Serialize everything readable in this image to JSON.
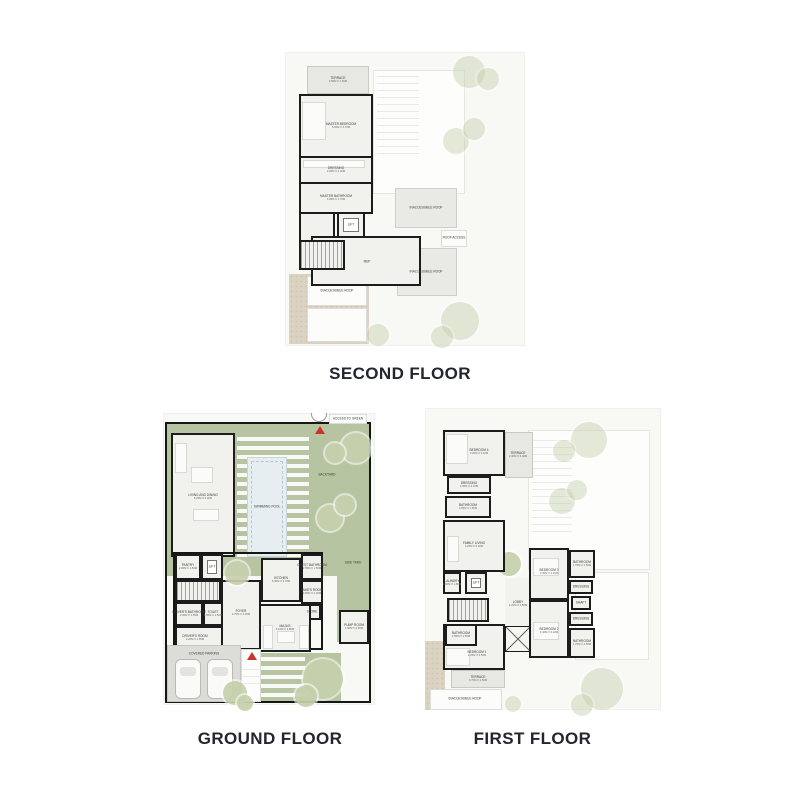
{
  "colors": {
    "wall": "#1c1c1c",
    "yard_green": "#b6c4a2",
    "pool_blue": "#e7eef1",
    "sand_beige": "#dbd3c2",
    "entry_red": "#c9342a",
    "title_text": "#23262e"
  },
  "titles": {
    "second": "SECOND FLOOR",
    "ground": "GROUND FLOOR",
    "first": "FIRST FLOOR"
  },
  "second": {
    "terrace": {
      "name": "TERRACE",
      "dims": "3.50M X 1.50M"
    },
    "master_bedroom": {
      "name": "MASTER BEDROOM",
      "dims": "5.95M X 4.70M"
    },
    "dressing": {
      "name": "DRESSING",
      "dims": "2.95M X 2.20M"
    },
    "master_bathroom": {
      "name": "MASTER BATHROOM",
      "dims": "3.95M X 2.70M"
    },
    "lift": {
      "name": "LIFT"
    },
    "mep": {
      "name": "MEP"
    },
    "roof_right_top": {
      "name": "INACCESSIBLE ROOF"
    },
    "roof_access": {
      "name": "ROOF ACCESS"
    },
    "roof_right_bottom": {
      "name": "INACCESSIBLE ROOF"
    },
    "roof_bottom_left": {
      "name": "INACCESSIBLE ROOF"
    }
  },
  "ground": {
    "access_to_green": {
      "name": "ACCESS TO GREEN"
    },
    "backyard": {
      "name": "BACKYARD"
    },
    "swimming_pool": {
      "name": "SWIMMING POOL"
    },
    "living_dining": {
      "name": "LIVING AND DINING",
      "dims": "8.25M X 6.00M"
    },
    "pantry": {
      "name": "PANTRY",
      "dims": "2.00M X 1.50M"
    },
    "lift": {
      "name": "LIFT"
    },
    "drivers_bathroom": {
      "name": "DRIVER'S BATHROOM",
      "dims": "2.00M X 1.55M"
    },
    "toilet": {
      "name": "TOILET",
      "dims": "2.00M X 1.50M"
    },
    "drivers_room": {
      "name": "DRIVER'S ROOM",
      "dims": "3.20M X 1.55M"
    },
    "covered_parking": {
      "name": "COVERED PARKING"
    },
    "foyer": {
      "name": "FOYER",
      "dims": "2.70M X 4.00M"
    },
    "kitchen": {
      "name": "KITCHEN",
      "dims": "5.40M X 3.70M"
    },
    "guest_bathroom": {
      "name": "GUEST BATHROOM",
      "dims": "2.55M X 1.50M"
    },
    "maids_room": {
      "name": "MAID'S ROOM",
      "dims": "3.00M X 2.00M"
    },
    "store": {
      "name": "STORE"
    },
    "majlis": {
      "name": "MAJLIS",
      "dims": "5.10M X 3.80M"
    },
    "pump_room": {
      "name": "PUMP ROOM",
      "dims": "1.80M X 2.80M"
    },
    "side_yard": {
      "name": "SIDE YARD"
    }
  },
  "first": {
    "bedroom4": {
      "name": "BEDROOM 4",
      "dims": "3.20M X 3.40M"
    },
    "terrace_top": {
      "name": "TERRACE",
      "dims": "2.30M X 3.00M"
    },
    "dressing4": {
      "name": "DRESSING",
      "dims": "2.95M X 2.20M"
    },
    "bathroom4": {
      "name": "BATHROOM",
      "dims": "2.95M X 1.80M"
    },
    "family_living": {
      "name": "FAMILY LIVING",
      "dims": "3.25M X 5.20M"
    },
    "laundry": {
      "name": "LAUNDRY",
      "dims": "1.60M X 1.80M"
    },
    "lift": {
      "name": "LIFT"
    },
    "lobby": {
      "name": "LOBBY",
      "dims": "2.20M X 2.80M"
    },
    "bedroom3": {
      "name": "BEDROOM 3",
      "dims": "3.40M X 4.20M"
    },
    "bathroom3": {
      "name": "BATHROOM",
      "dims": "1.70M X 2.80M"
    },
    "dressing3": {
      "name": "DRESSING",
      "dims": "1.00M X 1.40M"
    },
    "shaft": {
      "name": "SHAFT"
    },
    "dressing2": {
      "name": "DRESSING",
      "dims": "1.00M X 1.40M"
    },
    "bedroom2": {
      "name": "BEDROOM 2",
      "dims": "3.40M X 4.20M"
    },
    "bathroom2": {
      "name": "BATHROOM",
      "dims": "1.70M X 2.80M"
    },
    "bathroom1": {
      "name": "BATHROOM",
      "dims": "2.50M X 1.55M"
    },
    "bedroom1": {
      "name": "BEDROOM 1",
      "dims": "4.25M X 3.50M"
    },
    "terrace_bottom": {
      "name": "TERRACE",
      "dims": "3.70M X 1.50M"
    },
    "inaccessible_roof": {
      "name": "INACCESSIBLE ROOF"
    }
  }
}
